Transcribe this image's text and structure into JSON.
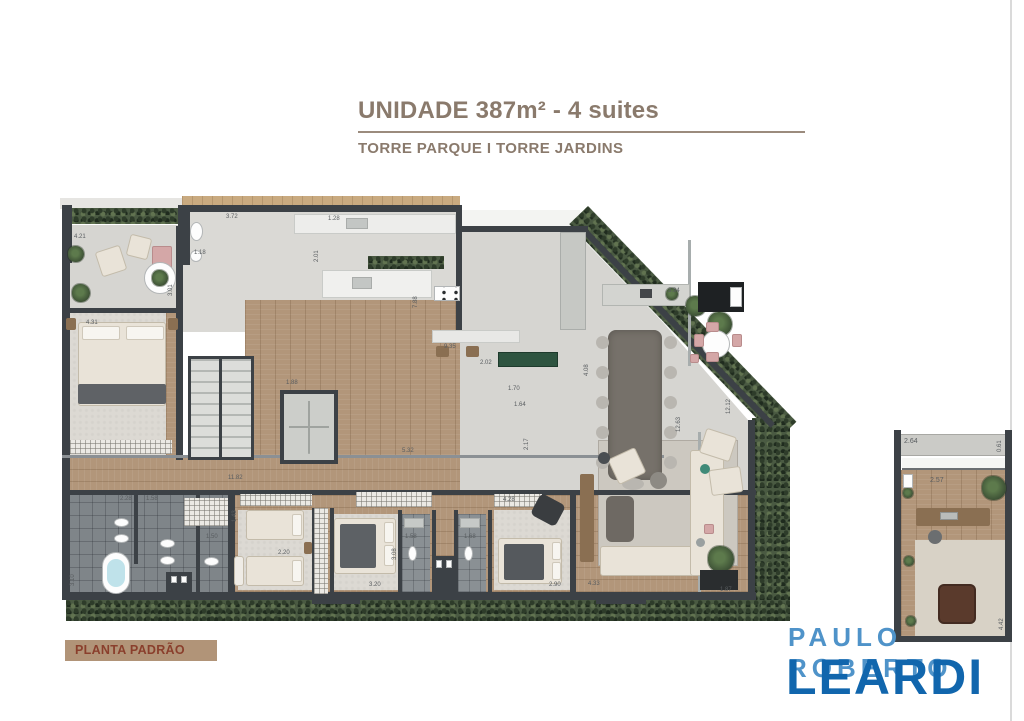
{
  "header": {
    "title": "UNIDADE 387m² - 4 suites",
    "subtitle": "TORRE PARQUE I TORRE JARDINS"
  },
  "footer_tag": {
    "label": "PLANTA PADRÃO"
  },
  "brand": {
    "line1": "PAULO ROBERTO",
    "line2": "LEARDI"
  },
  "colors": {
    "accent_brown": "#8a7a6c",
    "tag_bg": "#b19478",
    "tag_text": "#8a3f2c",
    "brand_light_blue": "#4f93c9",
    "brand_blue": "#1166ad",
    "wall": "#3c4146",
    "wood_floor": "#b2967a",
    "concrete_floor": "#d6d5d1",
    "bath_tile": "#7f8589",
    "hedge_green": "#4a5a42"
  },
  "plan": {
    "name": "main-unit-floor-plan",
    "dims": [
      {
        "v": "4.21"
      },
      {
        "v": "3.01"
      },
      {
        "v": "4.31"
      },
      {
        "v": "3.72"
      },
      {
        "v": "1.18"
      },
      {
        "v": "1.28"
      },
      {
        "v": "2.01"
      },
      {
        "v": "1.88"
      },
      {
        "v": "7.88"
      },
      {
        "v": "9.35"
      },
      {
        "v": "2.02"
      },
      {
        "v": "1.70"
      },
      {
        "v": "1.64"
      },
      {
        "v": "4.08"
      },
      {
        "v": "3.94"
      },
      {
        "v": "12.63"
      },
      {
        "v": "12.12"
      },
      {
        "v": "11.82"
      },
      {
        "v": "5.32"
      },
      {
        "v": "2.17"
      },
      {
        "v": "4.33"
      },
      {
        "v": "1.87"
      },
      {
        "v": "1.50"
      },
      {
        "v": "2.20"
      },
      {
        "v": "3.20"
      },
      {
        "v": "1.58"
      },
      {
        "v": "1.68"
      },
      {
        "v": "2.90"
      },
      {
        "v": "4.28"
      },
      {
        "v": "3.08"
      },
      {
        "v": "2.28"
      },
      {
        "v": "1.58"
      },
      {
        "v": "3.10"
      },
      {
        "v": "1.43"
      }
    ]
  },
  "annex_plan": {
    "name": "annex-room-plan",
    "dims": [
      {
        "v": "2.64"
      },
      {
        "v": "0.61"
      },
      {
        "v": "2.57"
      },
      {
        "v": "4.42"
      }
    ]
  }
}
